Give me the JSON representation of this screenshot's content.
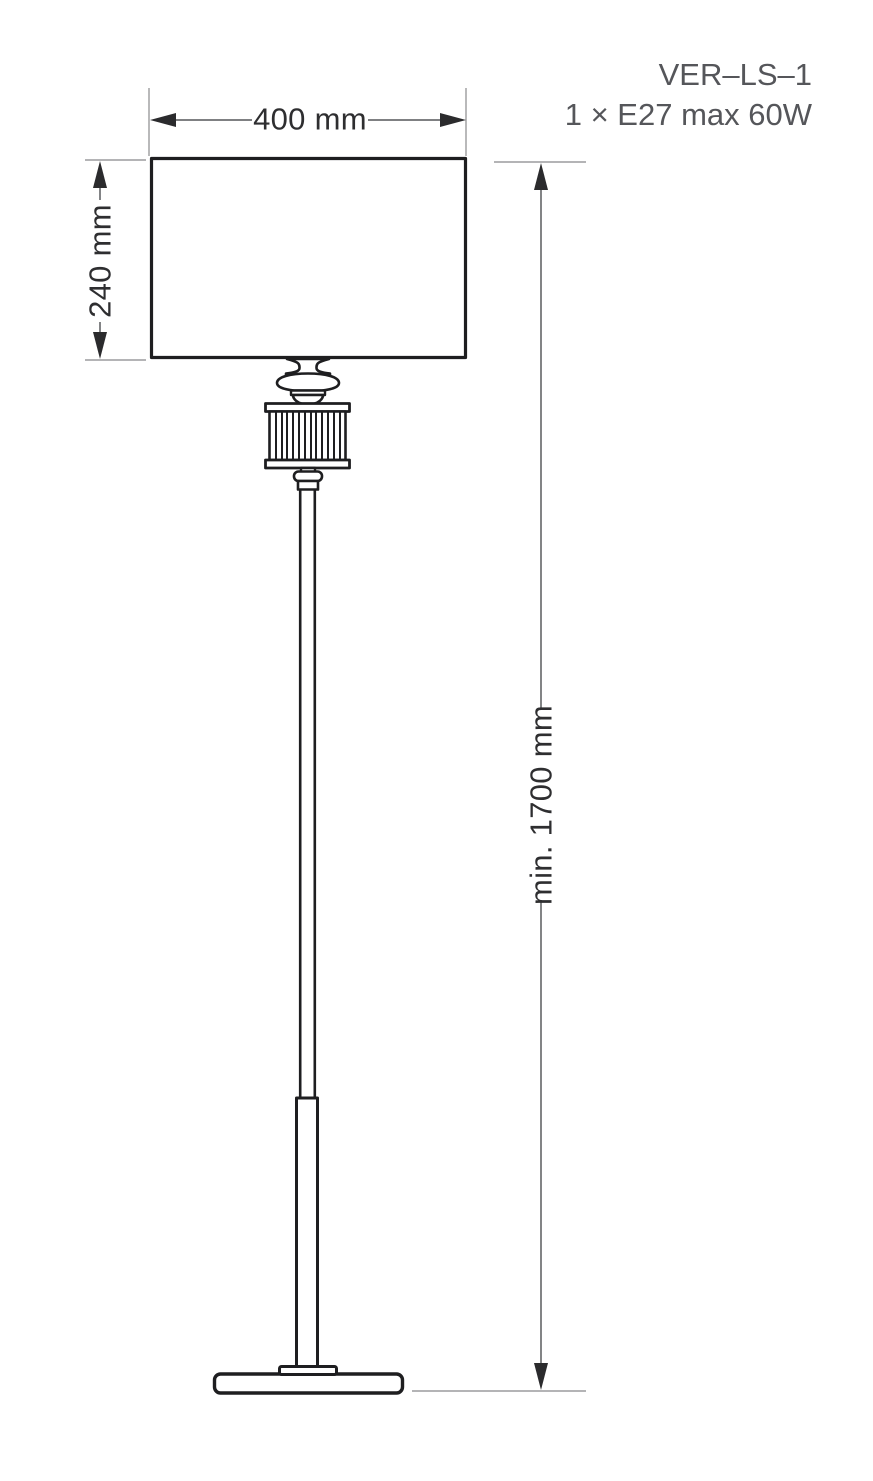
{
  "product": {
    "code": "VER–LS–1",
    "spec": "1 × E27 max 60W"
  },
  "dimensions": {
    "shade_width": {
      "label": "400 mm"
    },
    "shade_height": {
      "label": "240 mm"
    },
    "total_height": {
      "label": "min. 1700 mm"
    }
  },
  "drawing": {
    "subject": "floor-lamp technical dimension drawing"
  },
  "colors": {
    "background": "#ffffff",
    "outline": "#1e1e20",
    "dimension_line": "#6d6e70",
    "extension_line": "#9b9b9d",
    "arrow": "#2b2b2d",
    "dimension_text": "#2e2e30",
    "product_text": "#55565a"
  }
}
